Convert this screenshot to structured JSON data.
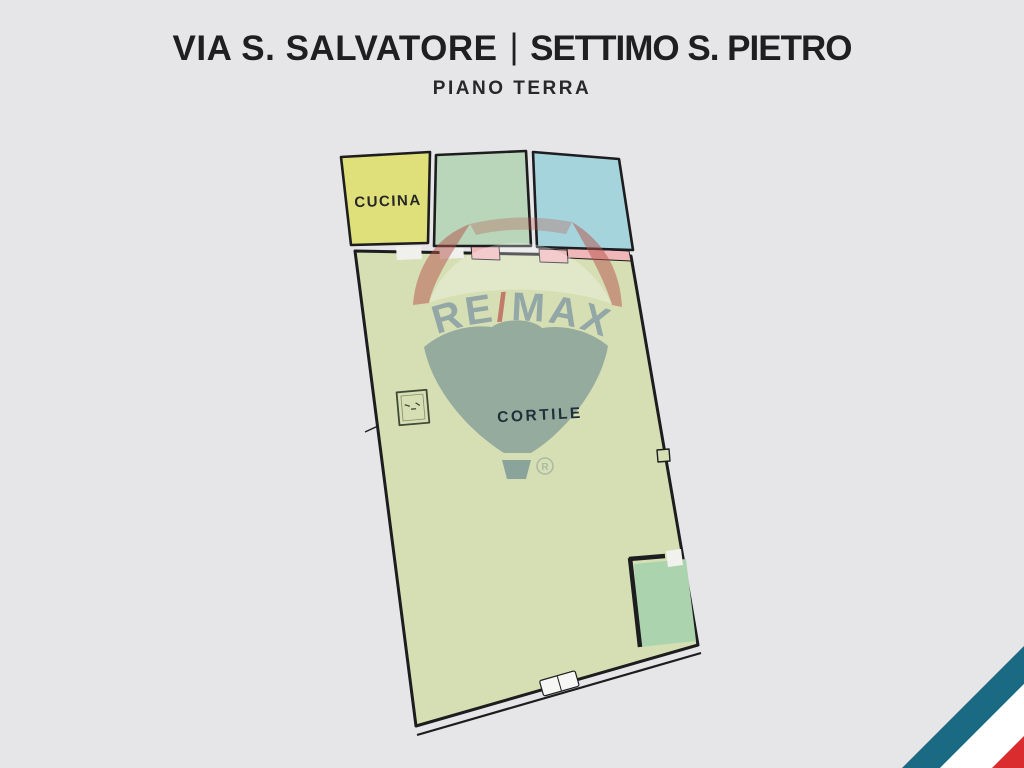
{
  "background_color": "#e6e6e8",
  "header": {
    "street": "VIA S. SALVATORE",
    "separator": "|",
    "city": "SETTIMO S. PIETRO",
    "floor_label": "PIANO TERRA"
  },
  "floorplan": {
    "wall_color": "#1d1d1f",
    "door_color": "#f0b7b9",
    "rooms": [
      {
        "name": "cucina",
        "label": "CUCINA",
        "fill": "#dfe07a"
      },
      {
        "name": "room-green",
        "label": "",
        "fill": "#b9d6ba"
      },
      {
        "name": "room-blue",
        "label": "",
        "fill": "#a6d4dc"
      },
      {
        "name": "cortile",
        "label": "CORTILE",
        "fill": "#d6dfb4"
      },
      {
        "name": "room-small-green",
        "label": "",
        "fill": "#abd4ae"
      }
    ]
  },
  "watermark": {
    "brand_re": "RE",
    "brand_slash": "/",
    "brand_max": "MAX",
    "registered_mark": "R",
    "text_color": "#7f98a3",
    "slash_color": "#bd5f55",
    "balloon_top_color": "#b5524a",
    "balloon_bottom_color": "#4e7286"
  },
  "corner_ribbon": {
    "teal": "#1a6a84",
    "white": "#ffffff",
    "red": "#da2c2e"
  }
}
